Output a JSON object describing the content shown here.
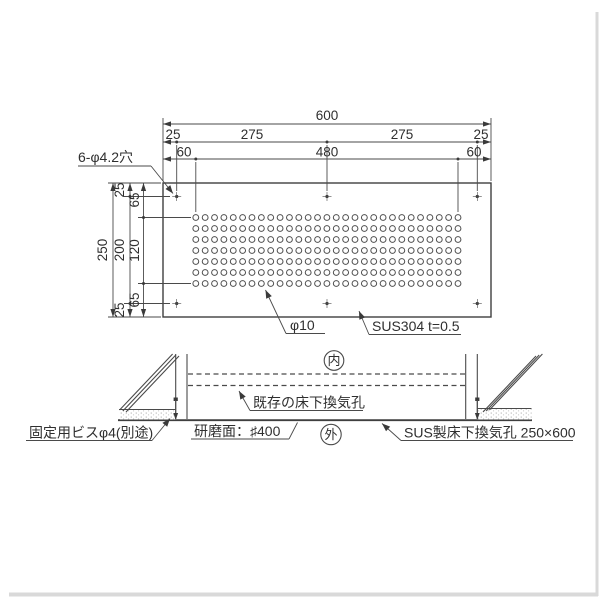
{
  "drawing": {
    "title_implied": "SUS underfloor ventilation panel drawing",
    "colors": {
      "line": "#4a4a4a",
      "text": "#2f2f2f",
      "frame_shadow": "#d9d9d9",
      "background": "#ffffff"
    },
    "top_view": {
      "dims_top": {
        "overall": "600",
        "row2": [
          "25",
          "275",
          "275",
          "25"
        ],
        "row3": [
          "60",
          "480",
          "60"
        ]
      },
      "dims_left": {
        "outer": "250",
        "middle": [
          "25",
          "200",
          "25"
        ],
        "inner": [
          "65",
          "120",
          "65"
        ]
      },
      "labels": {
        "mount_holes": "6-φ4.2穴",
        "hole_dia": "φ10",
        "material": "SUS304 t=0.5"
      },
      "perforation_grid": {
        "columns": 29,
        "rows": 7,
        "hole_symbol": "φ10",
        "mount_hole_count": 6
      }
    },
    "section_view": {
      "inside_mark": "内",
      "outside_mark": "外",
      "labels": {
        "existing_vent": "既存の床下換気孔",
        "screw": "固定用ビスφ4(別途)",
        "polish": "研磨面：♯400",
        "product": "SUS製床下換気孔 250×600"
      }
    }
  }
}
